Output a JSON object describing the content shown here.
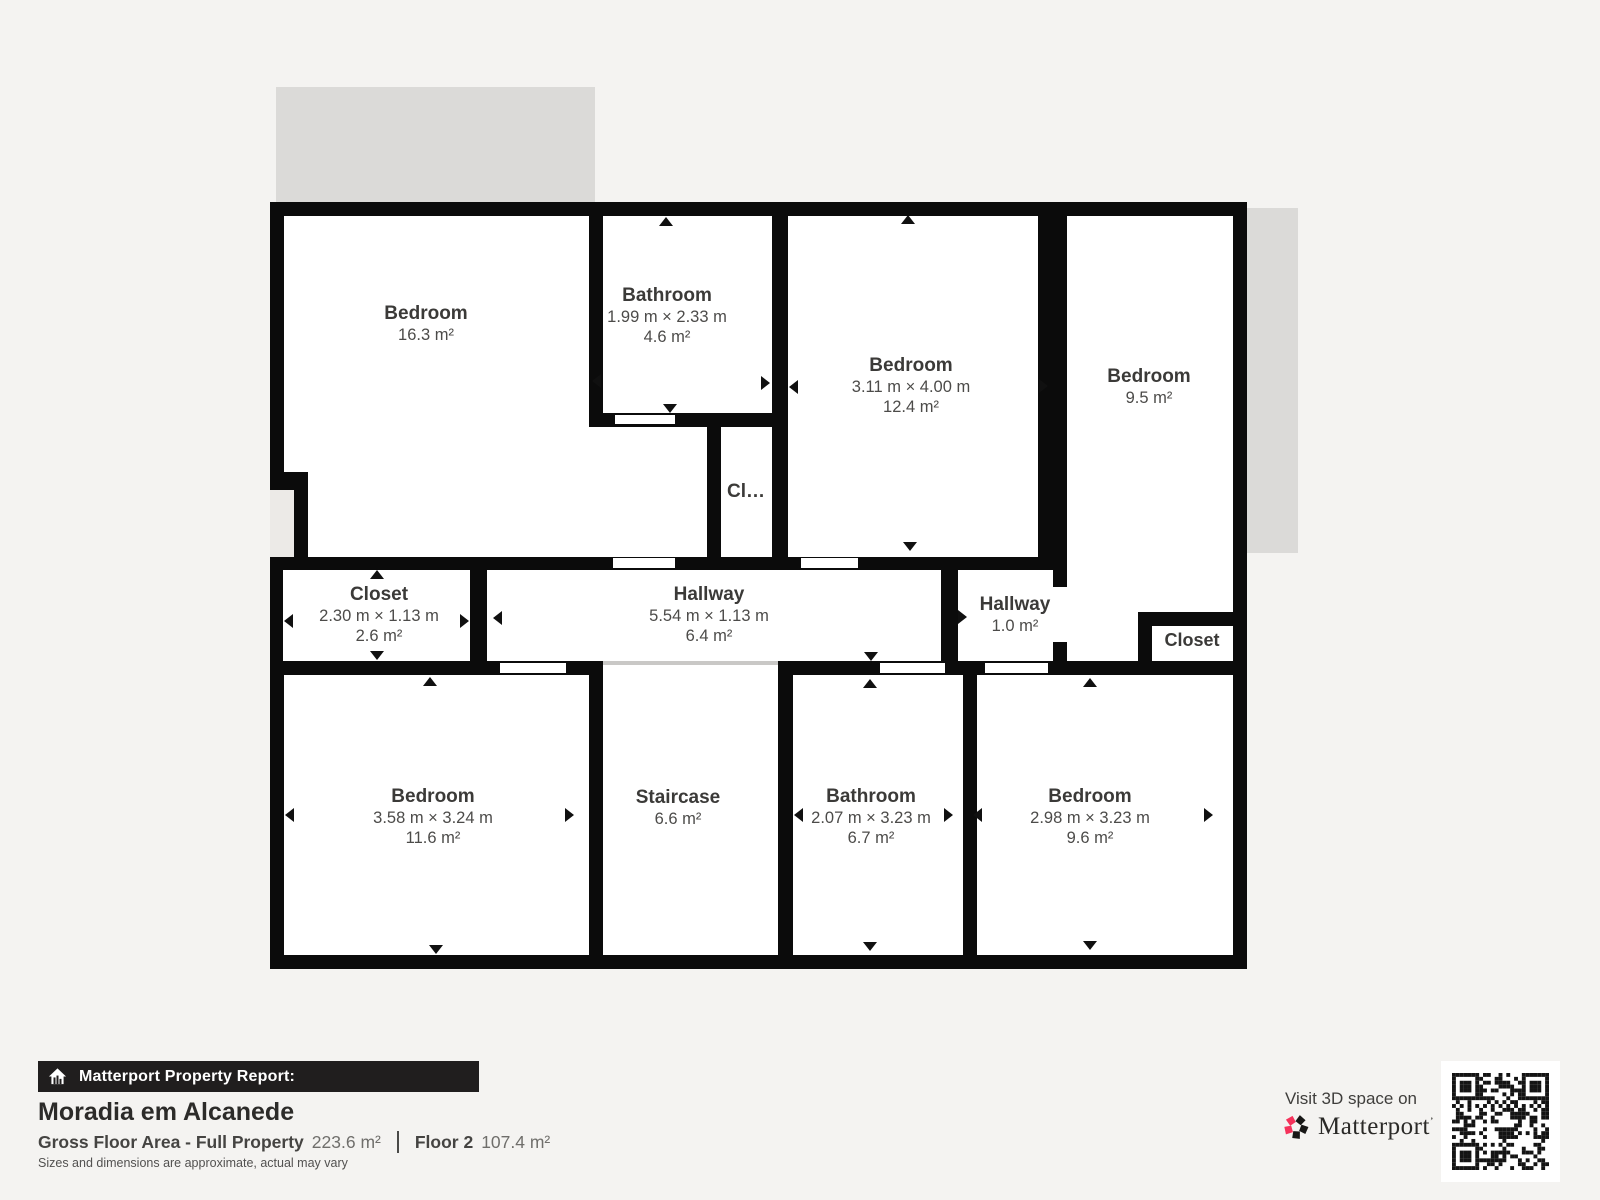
{
  "floorplan": {
    "rooms": [
      {
        "name": "Bedroom",
        "dims": "",
        "area": "16.3 m²"
      },
      {
        "name": "Bathroom",
        "dims": "1.99 m × 2.33 m",
        "area": "4.6 m²"
      },
      {
        "name": "Bedroom",
        "dims": "3.11 m × 4.00 m",
        "area": "12.4 m²"
      },
      {
        "name": "Bedroom",
        "dims": "",
        "area": "9.5 m²"
      },
      {
        "name": "Cl…",
        "dims": "",
        "area": ""
      },
      {
        "name": "Closet",
        "dims": "2.30 m × 1.13 m",
        "area": "2.6 m²"
      },
      {
        "name": "Hallway",
        "dims": "5.54 m × 1.13 m",
        "area": "6.4 m²"
      },
      {
        "name": "Hallway",
        "dims": "",
        "area": "1.0 m²"
      },
      {
        "name": "Closet",
        "dims": "",
        "area": ""
      },
      {
        "name": "Bedroom",
        "dims": "3.58 m × 3.24 m",
        "area": "11.6 m²"
      },
      {
        "name": "Staircase",
        "dims": "",
        "area": "6.6 m²"
      },
      {
        "name": "Bathroom",
        "dims": "2.07 m × 3.23 m",
        "area": "6.7 m²"
      },
      {
        "name": "Bedroom",
        "dims": "2.98 m × 3.23 m",
        "area": "9.6 m²"
      }
    ]
  },
  "report": {
    "banner": "Matterport Property Report:",
    "title": "Moradia em Alcanede",
    "gross_label": "Gross Floor Area - Full Property",
    "gross_value": "223.6 m²",
    "floor_label": "Floor 2",
    "floor_value": "107.4 m²",
    "disclaimer": "Sizes and dimensions are approximate, actual may vary"
  },
  "promo": {
    "visit_text": "Visit 3D space on",
    "brand": "Matterport",
    "colors": {
      "brand_red": "#f5325b",
      "wall": "#0b0b0b"
    }
  }
}
